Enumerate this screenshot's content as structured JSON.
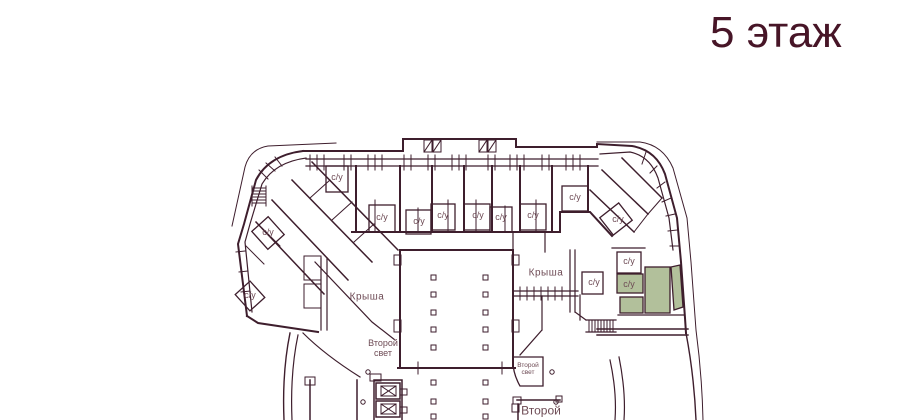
{
  "title": "5 этаж",
  "plan": {
    "strings": {
      "bathroom": "с/у",
      "roof": "Крыша",
      "second_light_line1": "Второй",
      "second_light_line2": "свет",
      "second_partial": "Второй"
    },
    "colors": {
      "line": "#3e1e2d",
      "label": "#6e4b55",
      "title": "#471527",
      "highlight_fill": "#b2c09b",
      "background": "#ffffff"
    }
  }
}
